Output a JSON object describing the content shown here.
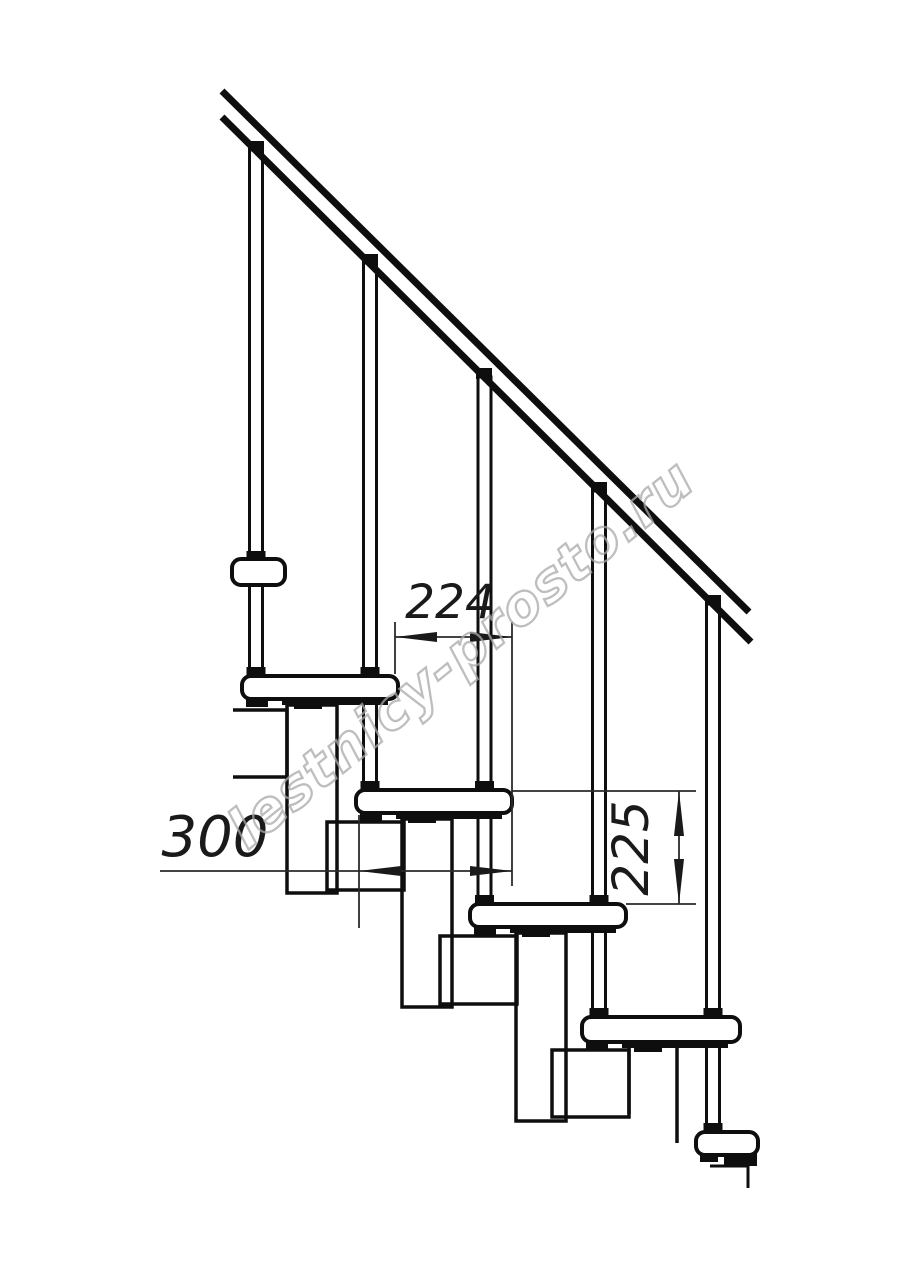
{
  "watermark": {
    "text": "lestnicy-prosto.ru",
    "color": "#a9a9a9"
  },
  "dimensions": {
    "tread_run": {
      "value": "224",
      "unit": "mm"
    },
    "tread_depth": {
      "value": "300",
      "unit": "mm"
    },
    "riser_height": {
      "value": "225",
      "unit": "mm"
    }
  },
  "drawing": {
    "background": "#ffffff",
    "line_color": "#0e0e0e",
    "dim_line_color": "#2a2a2a"
  }
}
